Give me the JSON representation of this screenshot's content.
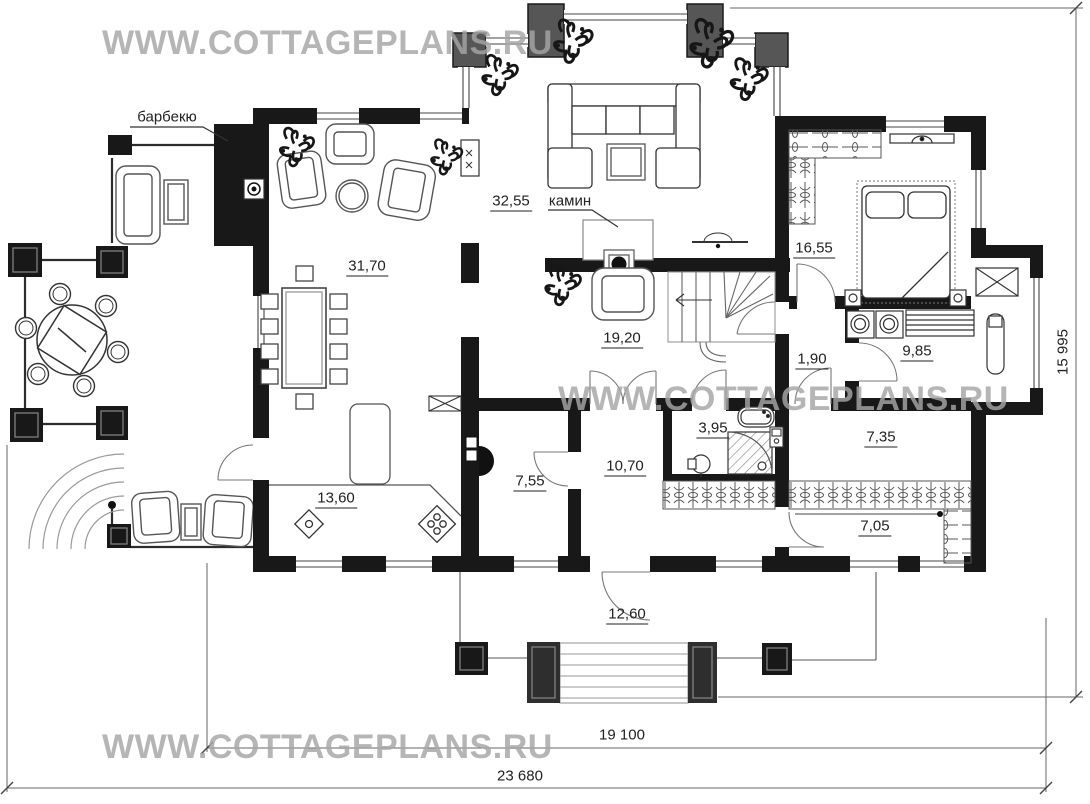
{
  "watermarks": {
    "top": "WWW.COTTAGEPLANS.RU",
    "middle": "WWW.COTTAGEPLANS.RU",
    "bottom": "WWW.COTTAGEPLANS.RU"
  },
  "callouts": {
    "barbecue": "барбекю",
    "fireplace": "камин"
  },
  "rooms": [
    {
      "name": "dining-lounge",
      "area": "31,70"
    },
    {
      "name": "living-room",
      "area": "32,55"
    },
    {
      "name": "hall",
      "area": "19,20"
    },
    {
      "name": "bedroom",
      "area": "16,55"
    },
    {
      "name": "corridor",
      "area": "1,90"
    },
    {
      "name": "bathroom",
      "area": "9,85"
    },
    {
      "name": "kitchen",
      "area": "13,60"
    },
    {
      "name": "boiler-room",
      "area": "7,55"
    },
    {
      "name": "entrance-hall",
      "area": "10,70"
    },
    {
      "name": "wc-shower",
      "area": "3,95"
    },
    {
      "name": "pantry",
      "area": "7,35"
    },
    {
      "name": "wardrobe",
      "area": "7,05"
    },
    {
      "name": "porch",
      "area": "12,60"
    }
  ],
  "dimensions": {
    "inner_width": "19 100",
    "total_width": "23 680",
    "total_height": "15 995"
  },
  "colors": {
    "wall": "#181818",
    "pilaster": "#565656",
    "line": "#555555",
    "watermark": "#a6a6a6"
  }
}
